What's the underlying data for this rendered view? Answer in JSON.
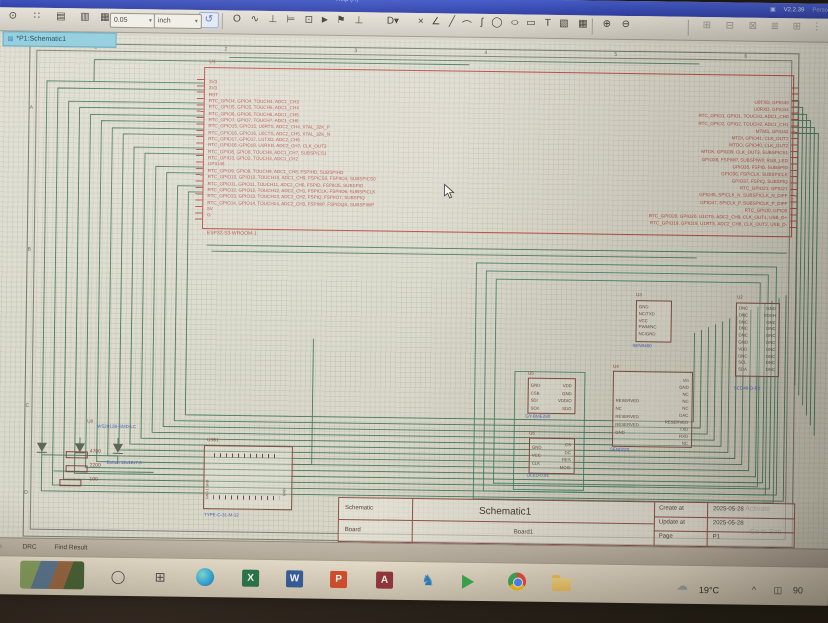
{
  "titlebar": {
    "help": "Help (H)",
    "version": "V2.2.39",
    "user": "Perso",
    "icon": "▣"
  },
  "toolbar": {
    "grid_value": "0.05",
    "unit_value": "inch",
    "caret": "▾",
    "icons": [
      {
        "name": "zoom-icon",
        "glyph": "⊙",
        "x": 4
      },
      {
        "name": "selection-dots-icon",
        "glyph": "∷",
        "x": 28
      },
      {
        "name": "sheet-icon",
        "glyph": "▤",
        "x": 52
      },
      {
        "name": "sheet-settings-icon",
        "glyph": "▥",
        "x": 76
      },
      {
        "name": "grid-icon",
        "glyph": "▦",
        "x": 96
      },
      {
        "name": "undo-icon",
        "glyph": "↺",
        "x": 199,
        "cls": "blueico"
      },
      {
        "name": "toolbar-divider",
        "glyph": "",
        "x": 222,
        "cls": "tdiv"
      },
      {
        "name": "polygon-icon",
        "glyph": "O",
        "x": 228
      },
      {
        "name": "wire-icon",
        "glyph": "∿",
        "x": 246
      },
      {
        "name": "pin-icon",
        "glyph": "⊥",
        "x": 264
      },
      {
        "name": "bus-icon",
        "glyph": "⊨",
        "x": 282
      },
      {
        "name": "netport-icon",
        "glyph": "⊡",
        "x": 300
      },
      {
        "name": "arrow-icon",
        "glyph": "►",
        "x": 316
      },
      {
        "name": "netflag-icon",
        "glyph": "⚑",
        "x": 332
      },
      {
        "name": "power-flag-icon",
        "glyph": "⊥",
        "x": 350
      },
      {
        "name": "dropdown-d-icon",
        "glyph": "D▾",
        "x": 384
      },
      {
        "name": "delete-icon",
        "glyph": "×",
        "x": 412
      },
      {
        "name": "polyline-icon",
        "glyph": "∠",
        "x": 427
      },
      {
        "name": "line-icon",
        "glyph": "╱",
        "x": 443
      },
      {
        "name": "arc-icon",
        "glyph": "⌒",
        "x": 458
      },
      {
        "name": "bezier-icon",
        "glyph": "ʃ",
        "x": 473
      },
      {
        "name": "circle-icon",
        "glyph": "◯",
        "x": 488
      },
      {
        "name": "ellipse-icon",
        "glyph": "○",
        "x": 506,
        "cls": "wide"
      },
      {
        "name": "rect-icon",
        "glyph": "▭",
        "x": 522
      },
      {
        "name": "text-icon",
        "glyph": "T",
        "x": 539
      },
      {
        "name": "image-icon",
        "glyph": "▧",
        "x": 555
      },
      {
        "name": "table-icon",
        "glyph": "▦",
        "x": 574
      },
      {
        "name": "toolbar-divider",
        "glyph": "",
        "x": 592,
        "cls": "tdiv"
      },
      {
        "name": "find-icon",
        "glyph": "⊕",
        "x": 598
      },
      {
        "name": "find-replace-icon",
        "glyph": "⊖",
        "x": 617
      },
      {
        "name": "toolbar-divider",
        "glyph": "",
        "x": 688,
        "cls": "tdiv"
      },
      {
        "name": "align-left-icon",
        "glyph": "⊞",
        "x": 698,
        "cls": "grayico"
      },
      {
        "name": "align-center-icon",
        "glyph": "⊟",
        "x": 721,
        "cls": "grayico"
      },
      {
        "name": "align-right-icon",
        "glyph": "⊠",
        "x": 744,
        "cls": "grayico"
      },
      {
        "name": "align-top-icon",
        "glyph": "≣",
        "x": 766,
        "cls": "grayico"
      },
      {
        "name": "align-bottom-icon",
        "glyph": "⊞",
        "x": 788,
        "cls": "grayico"
      },
      {
        "name": "distribute-icon",
        "glyph": "⋮",
        "x": 808,
        "cls": "grayico"
      }
    ]
  },
  "tab": {
    "label": "*P1:Schematic1",
    "icon": "▤"
  },
  "sheet": {
    "col_labels": [
      {
        "name": "col-label-1",
        "label": "1",
        "x": 95
      },
      {
        "name": "col-label-2",
        "label": "2",
        "x": 225
      },
      {
        "name": "col-label-3",
        "label": "3",
        "x": 355
      },
      {
        "name": "col-label-4",
        "label": "4",
        "x": 485
      },
      {
        "name": "col-label-5",
        "label": "5",
        "x": 615
      },
      {
        "name": "col-label-6",
        "label": "6",
        "x": 745
      }
    ],
    "row_labels": [
      {
        "name": "row-label-a",
        "label": "A",
        "y": 70
      },
      {
        "name": "row-label-b",
        "label": "B",
        "y": 212
      },
      {
        "name": "row-label-c",
        "label": "C",
        "y": 368
      },
      {
        "name": "row-label-d",
        "label": "D",
        "y": 455
      }
    ]
  },
  "u1": {
    "ref": "U1",
    "part": "ESP32-S3-WROOM-1",
    "left_pins": [
      "3V3",
      "3V3",
      "RST",
      "RTC_GPIO4, GPIO4, TOUCH4, ADC1_CH3",
      "RTC_GPIO5, GPIO5, TOUCH5, ADC1_CH4",
      "RTC_GPIO6, GPIO6, TOUCH6, ADC1_CH5",
      "RTC_GPIO7, GPIO7, TOUCH7, ADC1_CH6",
      "RTC_GPIO15, GPIO15, U0RTS, ADC2_CH4, XTAL_32K_P",
      "RTC_GPIO16, GPIO16, U0CTS, ADC2_CH5, XTAL_32K_N",
      "RTC_GPIO17, GPIO17, U1TXD, ADC2_CH6",
      "RTC_GPIO18, GPIO18, U1RXD, ADC2_CH7, CLK_OUT3",
      "RTC_GPIO8, GPIO8, TOUCH8, ADC1_CH7, SUBSPICS1",
      "RTC_GPIO3, GPIO3, TOUCH3, ADC1_CH2",
      "GPIO46",
      "RTC_GPIO9, GPIO9, TOUCH9, ADC1_CH8, FSPIHD, SUBSPIHD",
      "RTC_GPIO10, GPIO10, TOUCH10, ADC1_CH9, FSPICS0, FSPIIO4, SUBSPICS0",
      "RTC_GPIO11, GPIO11, TOUCH11, ADC2_CH0, FSPID, FSPIIO5, SUBSPID",
      "RTC_GPIO12, GPIO12, TOUCH12, ADC2_CH1, FSPICLK, FSPIIO6, SUBSPICLK",
      "RTC_GPIO13, GPIO13, TOUCH13, ADC2_CH2, FSPIQ, FSPIIO7, SUBSPIQ",
      "RTC_GPIO14, GPIO14, TOUCH14, ADC2_CH3, FSPIWP, FSPIDQS, SUBSPIWP",
      "5V",
      "G"
    ],
    "right_pins": [
      "U0TXD, GPIO43",
      "U0RXD, GPIO44",
      "RTC_GPIO1, GPIO1, TOUCH1, ADC1_CH0",
      "RTC_GPIO2, GPIO2, TOUCH2, ADC1_CH1",
      "MTMS, GPIO42",
      "MTDI, GPIO41, CLK_OUT1",
      "MTDO, GPIO40, CLK_OUT2",
      "MTCK, GPIO39, CLK_OUT3, SUBSPICS1",
      "GPIO38, FSPIWP, SUBSPIWP, RGB_LED",
      "GPIO35, FSPID, SUBSPID",
      "GPIO36, FSPICLK, SUBSPICLK",
      "GPIO37, FSPIQ, SUBSPIQ",
      "RTC_GPIO21, GPIO21",
      "GPIO45, SPICLK_N, SUBSPICLK_N_DIFF",
      "GPIO47, SPICLK_P, SUBSPICLK_P_DIFF",
      "RTC_GPIO0, GPIO0",
      "RTC_GPIO20, GPIO20, U1CTS, ADC2_CH9, CLK_OUT1, USB_D+",
      "RTC_GPIO19, GPIO19, U1RTS, ADC2_CH8, CLK_OUT2, USB_D-"
    ]
  },
  "u2": {
    "ref": "U2",
    "part": "SCD40-D-R2",
    "left_pins": [
      "DNC",
      "DNC",
      "DNC",
      "DNC",
      "DNC",
      "GND",
      "VDD",
      "DNC",
      "SCL",
      "SDA"
    ],
    "right_pins": [
      "GND",
      "VDDH",
      "DNC",
      "DNC",
      "DNC",
      "DNC",
      "DNC",
      "DNC",
      "DNC",
      "DNC"
    ]
  },
  "u3": {
    "ref": "U3",
    "part": "SEN0460",
    "pins": [
      "GND",
      "NC/TXD",
      "VCC",
      "PWM/NC",
      "NC/GND"
    ]
  },
  "u4": {
    "ref": "U4",
    "part": "SEN0220",
    "left_pins": [
      "RESERVED",
      "NC",
      "RESERVED",
      "RESERVED",
      "GND"
    ],
    "right_pins": [
      "Vin",
      "GND",
      "NC",
      "NC",
      "NC",
      "DAC",
      "RESERVED",
      "TXD",
      "RXD",
      "NC"
    ]
  },
  "u5": {
    "ref": "U5",
    "part": "GY-BME280",
    "left_pins": [
      "GND",
      "CSB",
      "SDI",
      "SCK"
    ],
    "right_pins": [
      "VDD",
      "GND",
      "VDDIO",
      "SDO"
    ]
  },
  "u6": {
    "ref": "U6",
    "part": "OLED-0.91",
    "left_pins": [
      "GND",
      "VCC",
      "CLK"
    ],
    "right_pins": [
      "CS",
      "DC",
      "RES",
      "MOSI"
    ]
  },
  "u8": {
    "ref": "U8",
    "part": "WS2812B-SMD-LC"
  },
  "sw": {
    "label": "Button 12x12x7.3"
  },
  "usb": {
    "ref": "USB1",
    "part": "TYPE-C-31-M-12",
    "gnd_left": "GND 1 GND",
    "gnd_right": "GND"
  },
  "resistors": [
    "4700",
    "2200",
    "100"
  ],
  "title_block": {
    "schematic_label": "Schematic",
    "schematic_value": "Schematic1",
    "board_label": "Board",
    "board_value": "Board1",
    "create_label": "Create at",
    "create_value": "2025-05-28",
    "update_label": "Update at",
    "update_value": "2025-05-28",
    "page_label": "Page",
    "page_value": "P1"
  },
  "watermark": {
    "line1": "Activate",
    "line2": "Go to Sett"
  },
  "status_bar": {
    "items": [
      {
        "name": "status-item-partial",
        "label": "on",
        "x": 2,
        "cls": "faint"
      },
      {
        "name": "status-item-drc",
        "label": "DRC",
        "x": 30
      },
      {
        "name": "status-item-find-result",
        "label": "Find Result",
        "x": 62
      }
    ]
  },
  "taskbar": {
    "temperature": "19°C",
    "icons": [
      {
        "name": "cortana-icon",
        "glyph": "◯",
        "x": 116,
        "cls": "mono"
      },
      {
        "name": "task-view-icon",
        "glyph": "⊞",
        "x": 158,
        "cls": "mono"
      },
      {
        "name": "edge-icon",
        "glyph": "",
        "x": 204,
        "cls": "edge"
      },
      {
        "name": "excel-icon",
        "letter": "X",
        "x": 250,
        "cls": "office excel"
      },
      {
        "name": "word-icon",
        "letter": "W",
        "x": 294,
        "cls": "office word"
      },
      {
        "name": "powerpoint-icon",
        "letter": "P",
        "x": 338,
        "cls": "office ppt"
      },
      {
        "name": "access-icon",
        "letter": "A",
        "x": 384,
        "cls": "office access"
      },
      {
        "name": "person-icon",
        "glyph": "♞",
        "x": 426,
        "cls": "person"
      },
      {
        "name": "media-play-icon",
        "glyph": "",
        "x": 470,
        "cls": "greenplay"
      },
      {
        "name": "chrome-icon",
        "glyph": "",
        "x": 516,
        "cls": "chrome"
      },
      {
        "name": "folder-icon",
        "glyph": "",
        "x": 560,
        "cls": "folder"
      }
    ],
    "tray": [
      {
        "name": "weather-cloud-icon",
        "glyph": "☁",
        "x": 680,
        "cls": "cloud"
      },
      {
        "name": "temperature-label",
        "label": "19°C",
        "x": 702,
        "cls": "temp"
      },
      {
        "name": "tray-caret-icon",
        "glyph": "^",
        "x": 752
      },
      {
        "name": "tray-screen-icon",
        "glyph": "◫",
        "x": 776
      },
      {
        "name": "tray-battery-label",
        "label": "90",
        "x": 796
      }
    ]
  }
}
